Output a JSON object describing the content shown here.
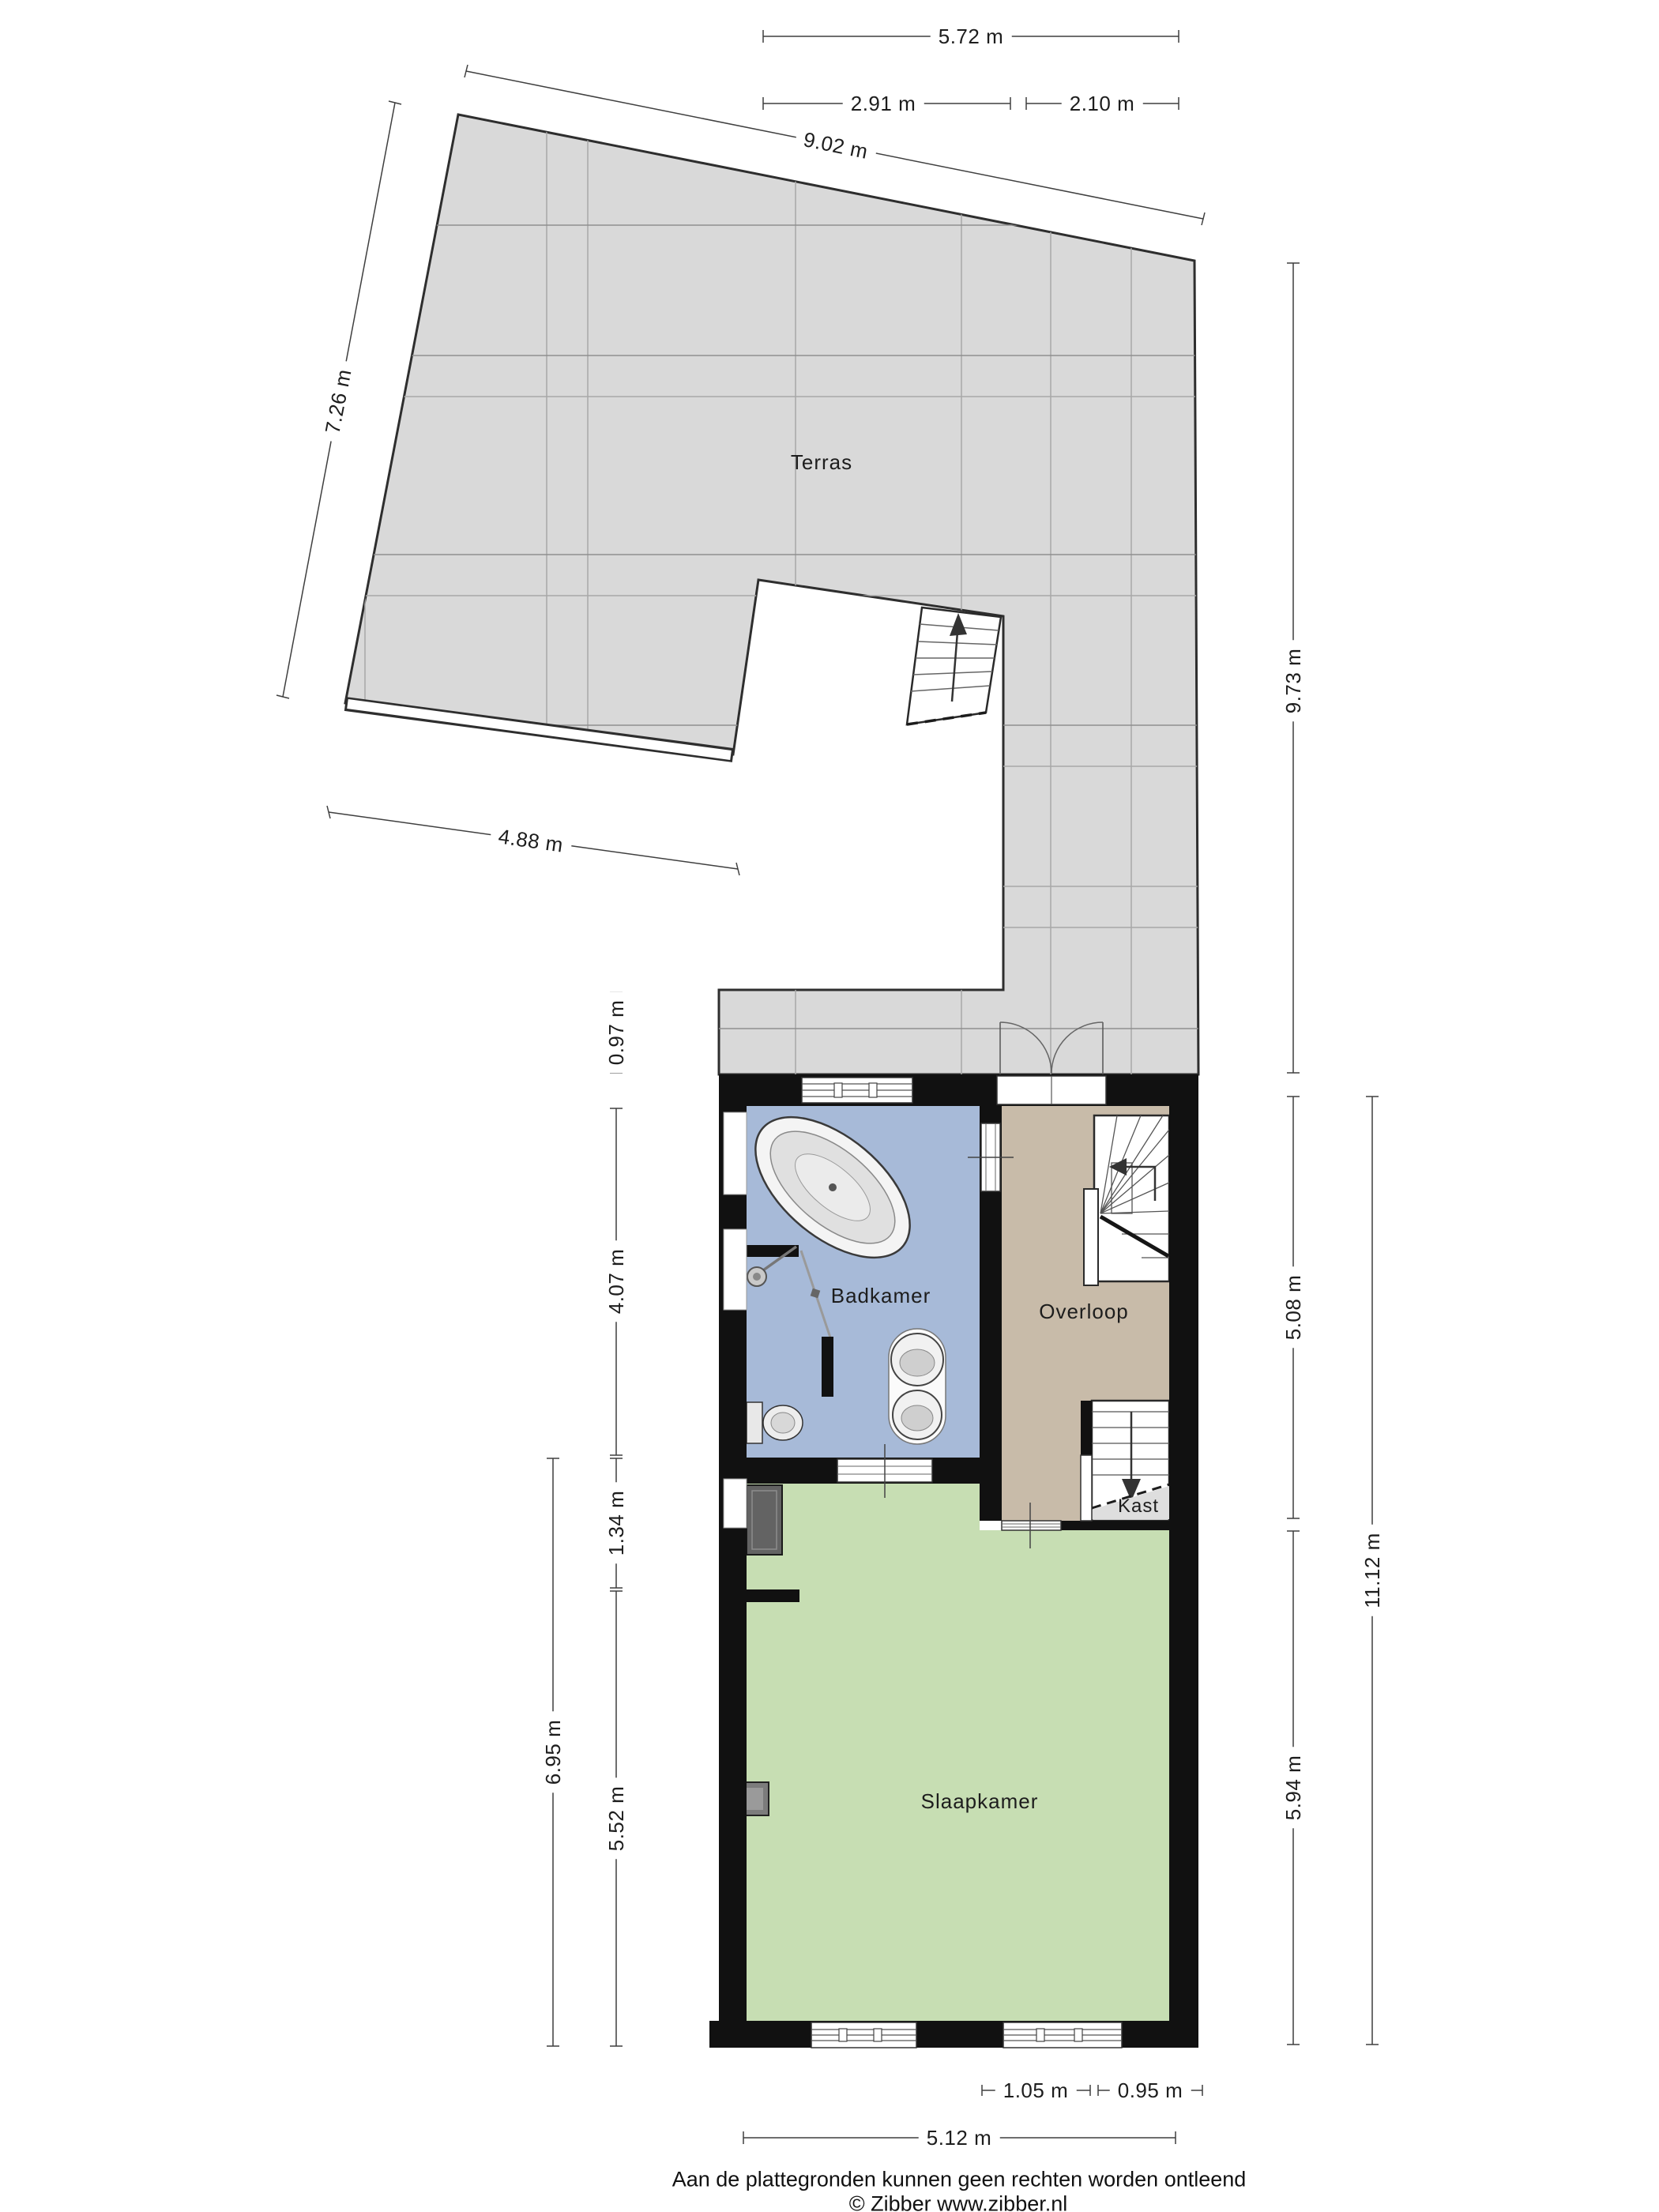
{
  "plan": {
    "type": "floorplan-first-floor",
    "rooms": {
      "terras": "Terras",
      "badkamer": "Badkamer",
      "overloop": "Overloop",
      "kast": "Kast",
      "slaapkamer": "Slaapkamer"
    },
    "dimensions": {
      "top_total_width": "5.72 m",
      "top_left_width": "2.91 m",
      "top_right_width": "2.10 m",
      "terrace_top_edge": "9.02 m",
      "terrace_left_edge": "7.26 m",
      "terrace_right_height": "9.73 m",
      "terrace_bottom_edge": "4.88 m",
      "front_strip_depth": "0.97 m",
      "badkamer_height": "4.07 m",
      "nook_height": "1.34 m",
      "slaapkamer_total_left": "6.95 m",
      "slaapkamer_height_left": "5.52 m",
      "overloop_height": "5.08 m",
      "slaapkamer_height_right": "5.94 m",
      "building_total_height": "11.12 m",
      "window_left_width": "1.05 m",
      "window_right_width": "0.95 m",
      "building_width": "5.12 m"
    },
    "footer": {
      "disclaimer": "Aan de plattegronden kunnen geen rechten worden ontleend",
      "credit": "© Zibber www.zibber.nl"
    },
    "colors": {
      "terrace_floor": "#d9d9d9",
      "terrace_grid_line": "#a8a8a8",
      "badkamer_floor": "#a7bad8",
      "overloop_floor": "#c8bba9",
      "slaapkamer_floor": "#c7deb3",
      "kast_under_stairs": "#dedede",
      "wall": "#111111",
      "dimension_line": "#3f3f3f",
      "furniture_fill": "#eeeeee",
      "wardrobe_fill": "#636363"
    }
  }
}
